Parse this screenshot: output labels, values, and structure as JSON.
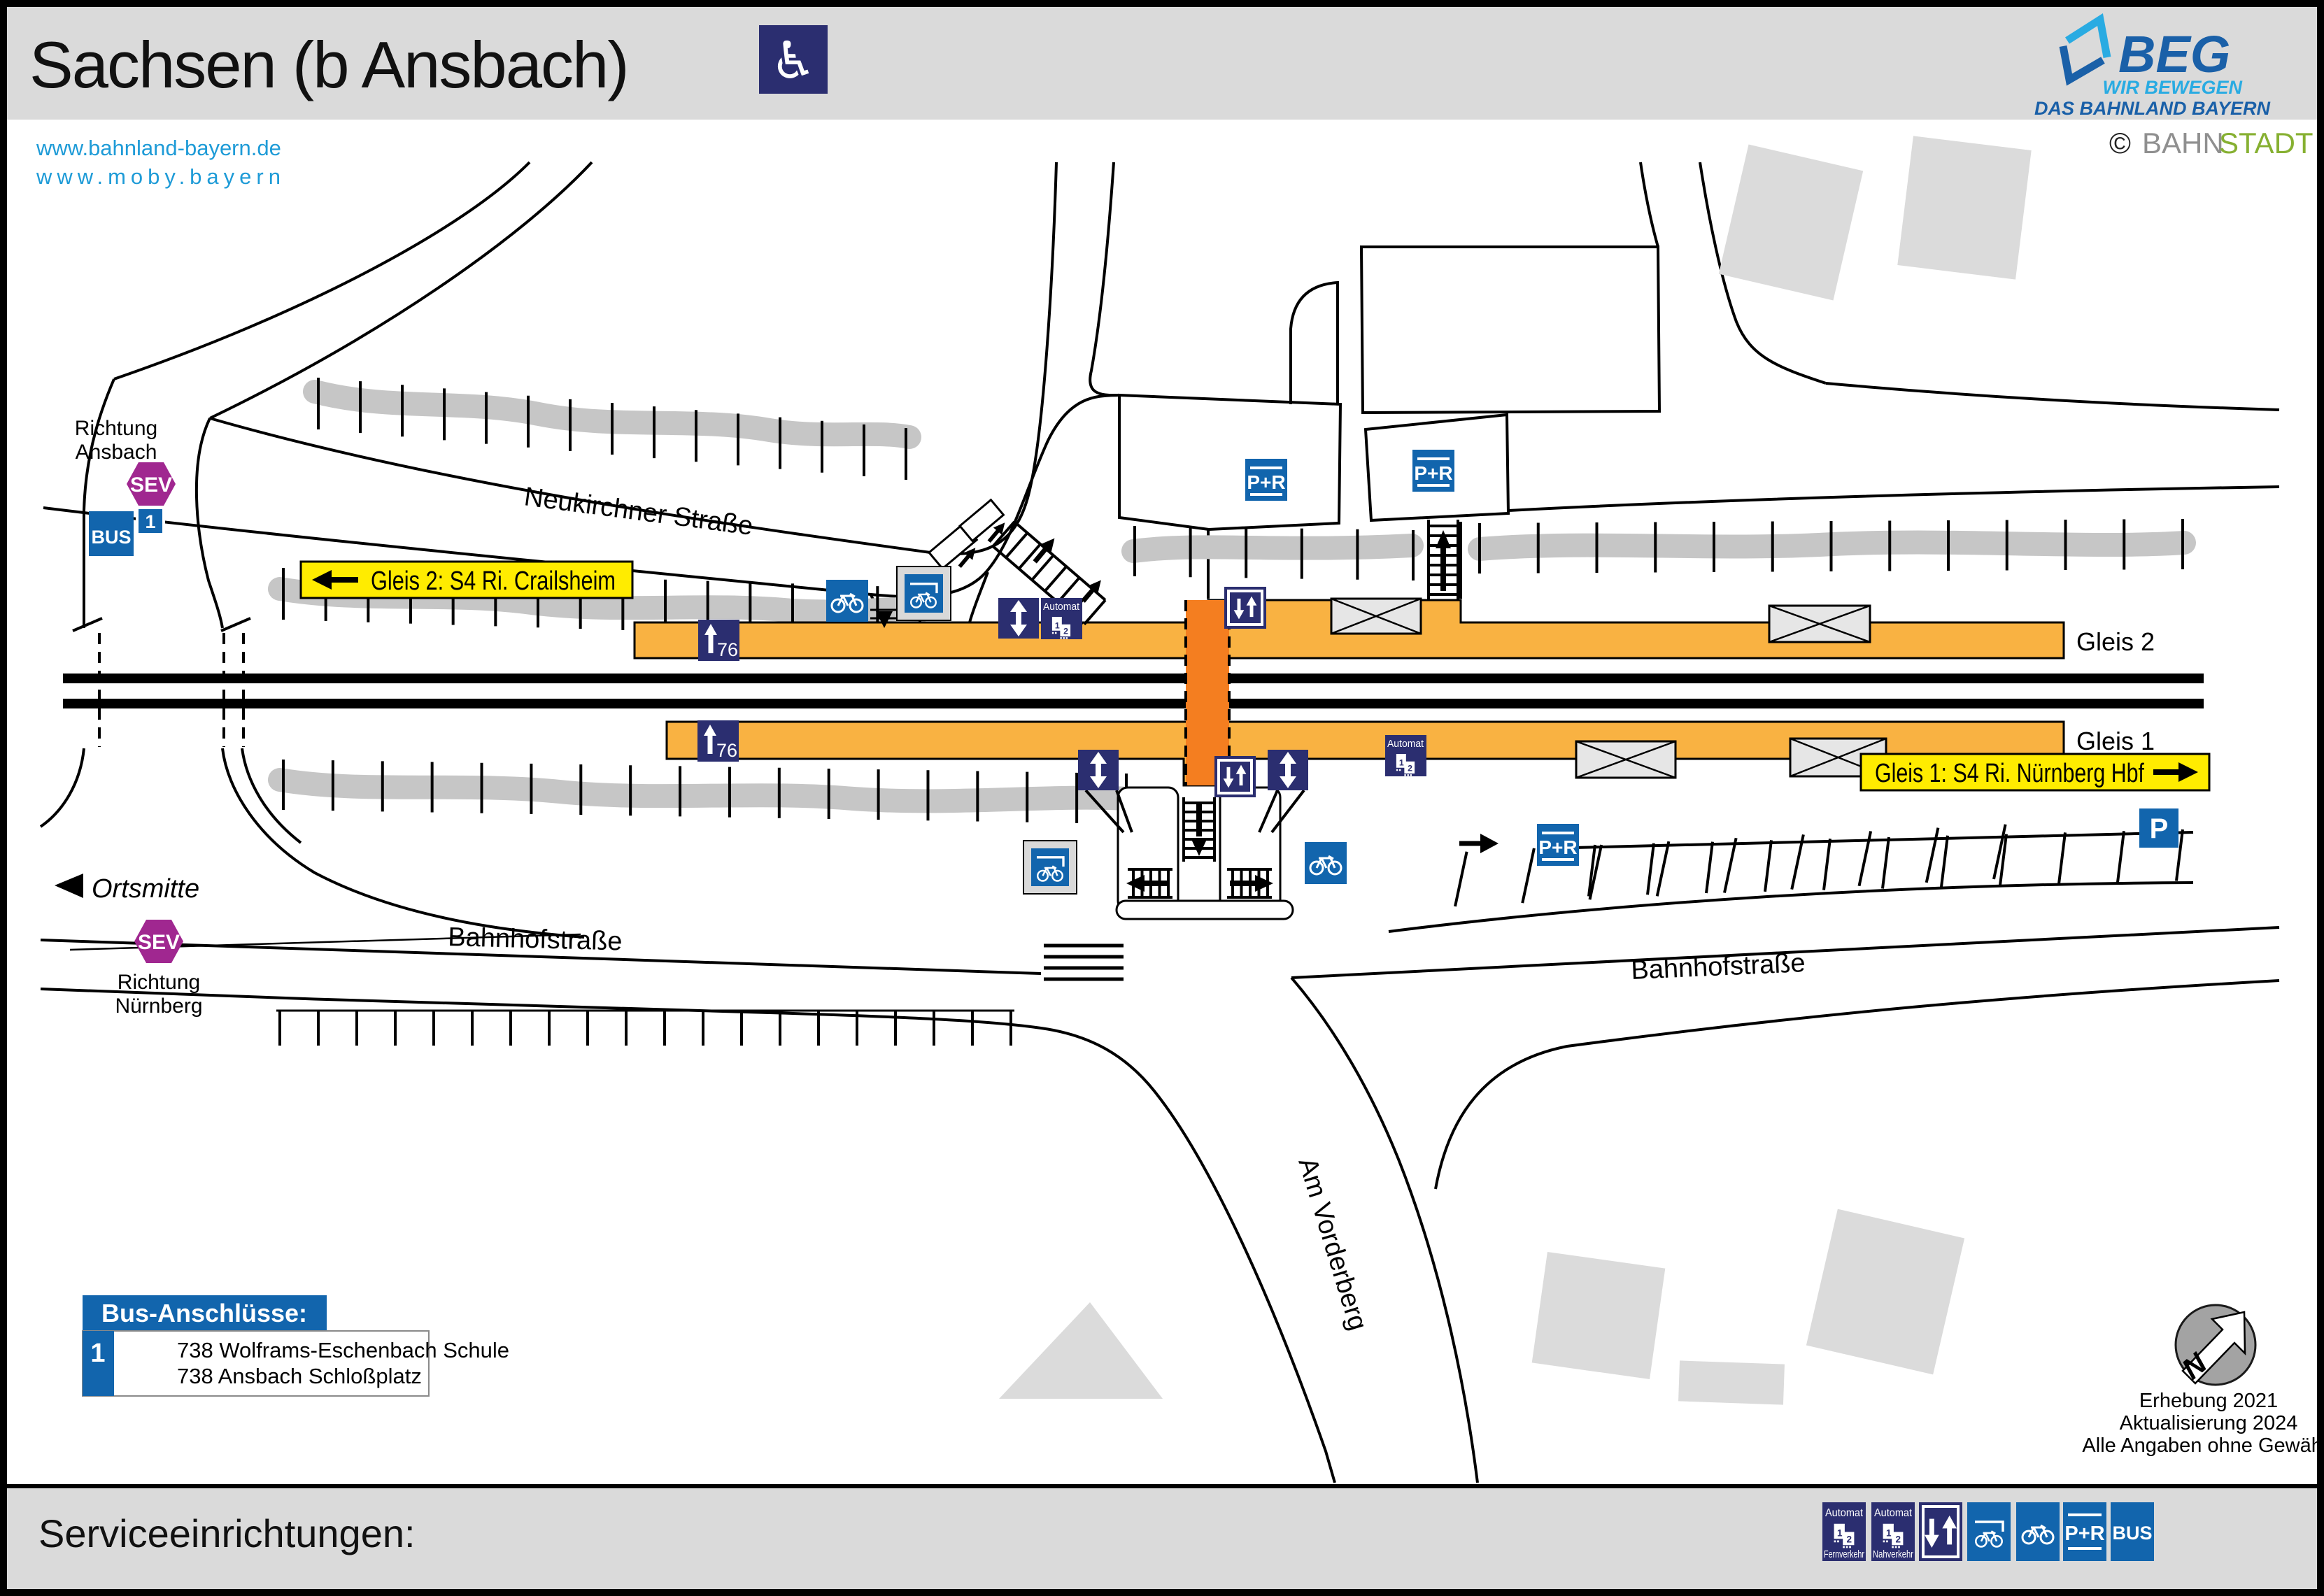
{
  "header": {
    "title": "Sachsen (b Ansbach)",
    "wheelchair_symbol": "♿"
  },
  "links": {
    "bahnland": "www.bahnland-bayern.de",
    "moby": "www.moby.bayern"
  },
  "branding": {
    "beg": "BEG",
    "tagline1": "WIR BEWEGEN",
    "tagline2": "DAS BAHNLAND BAYERN",
    "copyright": "©",
    "bahn": "BAHN",
    "stadt": "STADT"
  },
  "map": {
    "richtung_ansbach": [
      "Richtung",
      "Ansbach"
    ],
    "richtung_nuernberg": [
      "Richtung",
      "Nürnberg"
    ],
    "sev": "SEV",
    "bus": "BUS",
    "stop_number": "1",
    "sign_gleis2": "Gleis 2: S4 Ri. Crailsheim",
    "sign_gleis1": "Gleis 1: S4 Ri. Nürnberg Hbf",
    "street_neukirchner": "Neukirchner Straße",
    "street_bahnhof": "Bahnhofstraße",
    "street_vorderberg": "Am Vorderberg",
    "ortsmitte": "Ortsmitte",
    "gleis2": "Gleis 2",
    "gleis1": "Gleis 1",
    "platform_height": "76",
    "pr": "P+R",
    "p": "P",
    "automat": "Automat",
    "digit1": "1",
    "digit2": "2"
  },
  "bus_connections": {
    "title": "Bus-Anschlüsse:",
    "stop_number": "1",
    "line1": "738 Wolframs-Eschenbach Schule",
    "line2": "738 Ansbach Schloßplatz"
  },
  "survey": {
    "erhebung": "Erhebung 2021",
    "aktualisierung": "Aktualisierung 2024",
    "gewaehr": "Alle Angaben ohne Gewähr!",
    "north": "N"
  },
  "legend": {
    "title": "Serviceeinrichtungen:",
    "automat": "Automat",
    "fernverkehr": "Fernverkehr",
    "nahverkehr": "Nahverkehr",
    "pr": "P+R",
    "bus": "BUS"
  },
  "colors": {
    "navy": "#2B2E70",
    "blue": "#1265AD",
    "sev_purple": "#A02790",
    "sign_yellow": "#FFEC00",
    "platform_orange": "#F9B242",
    "crossing_orange": "#F47E20",
    "link_blue": "#1E9BD7",
    "beg_light_blue": "#29ABE2",
    "beg_dark_blue": "#1A60A8",
    "bahnstadt_green": "#86B031",
    "band_gray": "#DADADA"
  }
}
